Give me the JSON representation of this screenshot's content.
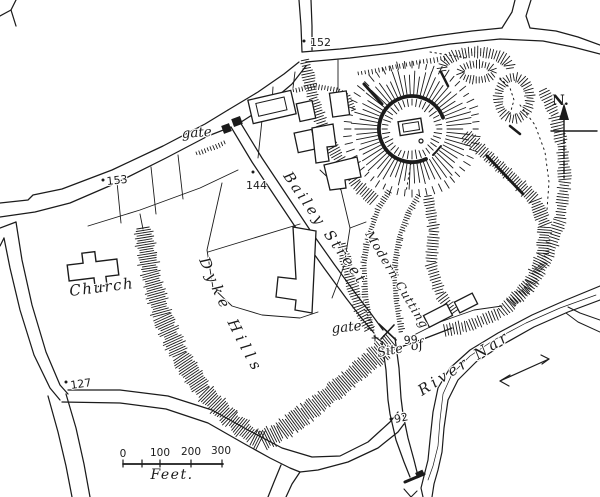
{
  "map": {
    "colors": {
      "ink": "#1b1b1b",
      "paper": "#ffffff"
    },
    "labels": {
      "church": "Church",
      "dyke_hills": "Dyke Hills",
      "bailey_street": "Bailey Street",
      "modern_cutting": "Modern Cutting",
      "river_nar": "River Nar",
      "gate_north": "gate",
      "gate_south": "gate",
      "site_of": "Site of",
      "north": "N."
    },
    "spot_heights": [
      "152",
      "153",
      "144",
      "127",
      "99",
      "92"
    ],
    "scale_bar": {
      "ticks": [
        "0",
        "100",
        "200",
        "300"
      ],
      "unit": "Feet."
    }
  }
}
